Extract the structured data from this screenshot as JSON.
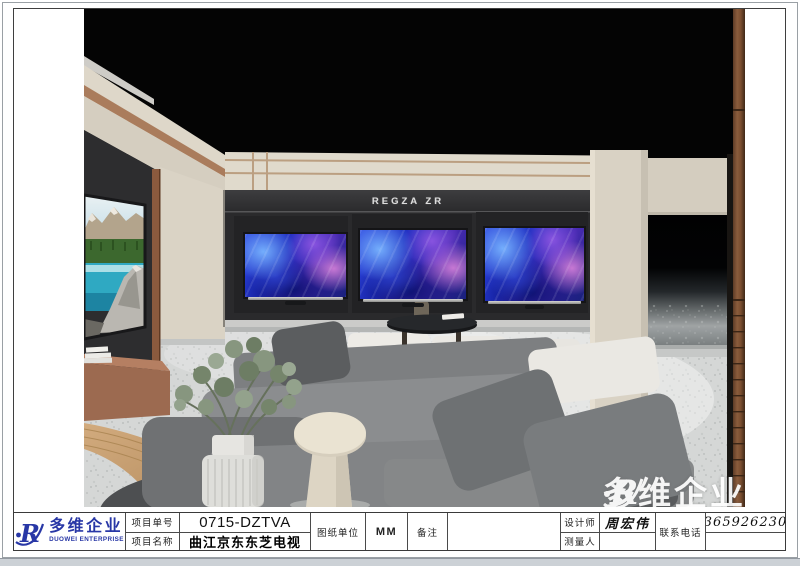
{
  "scene": {
    "sign": "REGZA ZR"
  },
  "watermark": {
    "text": "多维企业"
  },
  "title_block": {
    "logo": {
      "brand_cn": "多维企业",
      "brand_en": "DUOWEI ENTERPRISE"
    },
    "project_no_label": "项目单号",
    "project_no": "0715-DZTVA",
    "project_name_label": "项目名称",
    "project_name": "曲江京东东芝电视",
    "unit_label": "图纸单位",
    "unit": "MM",
    "remark_label": "备注",
    "remark": "",
    "designer_label": "设计师",
    "designer": "周宏伟",
    "surveyor_label": "测量人",
    "surveyor": "",
    "phone_label": "联系电话",
    "phone": "13659262305"
  },
  "colors": {
    "logo_blue": "#2837a6",
    "wood_trim": "#8a5a3e",
    "tv_screen_blue": "#2742d8",
    "wall_beige": "#ded7c9",
    "tv_wall_dark": "#2a2a2c"
  }
}
